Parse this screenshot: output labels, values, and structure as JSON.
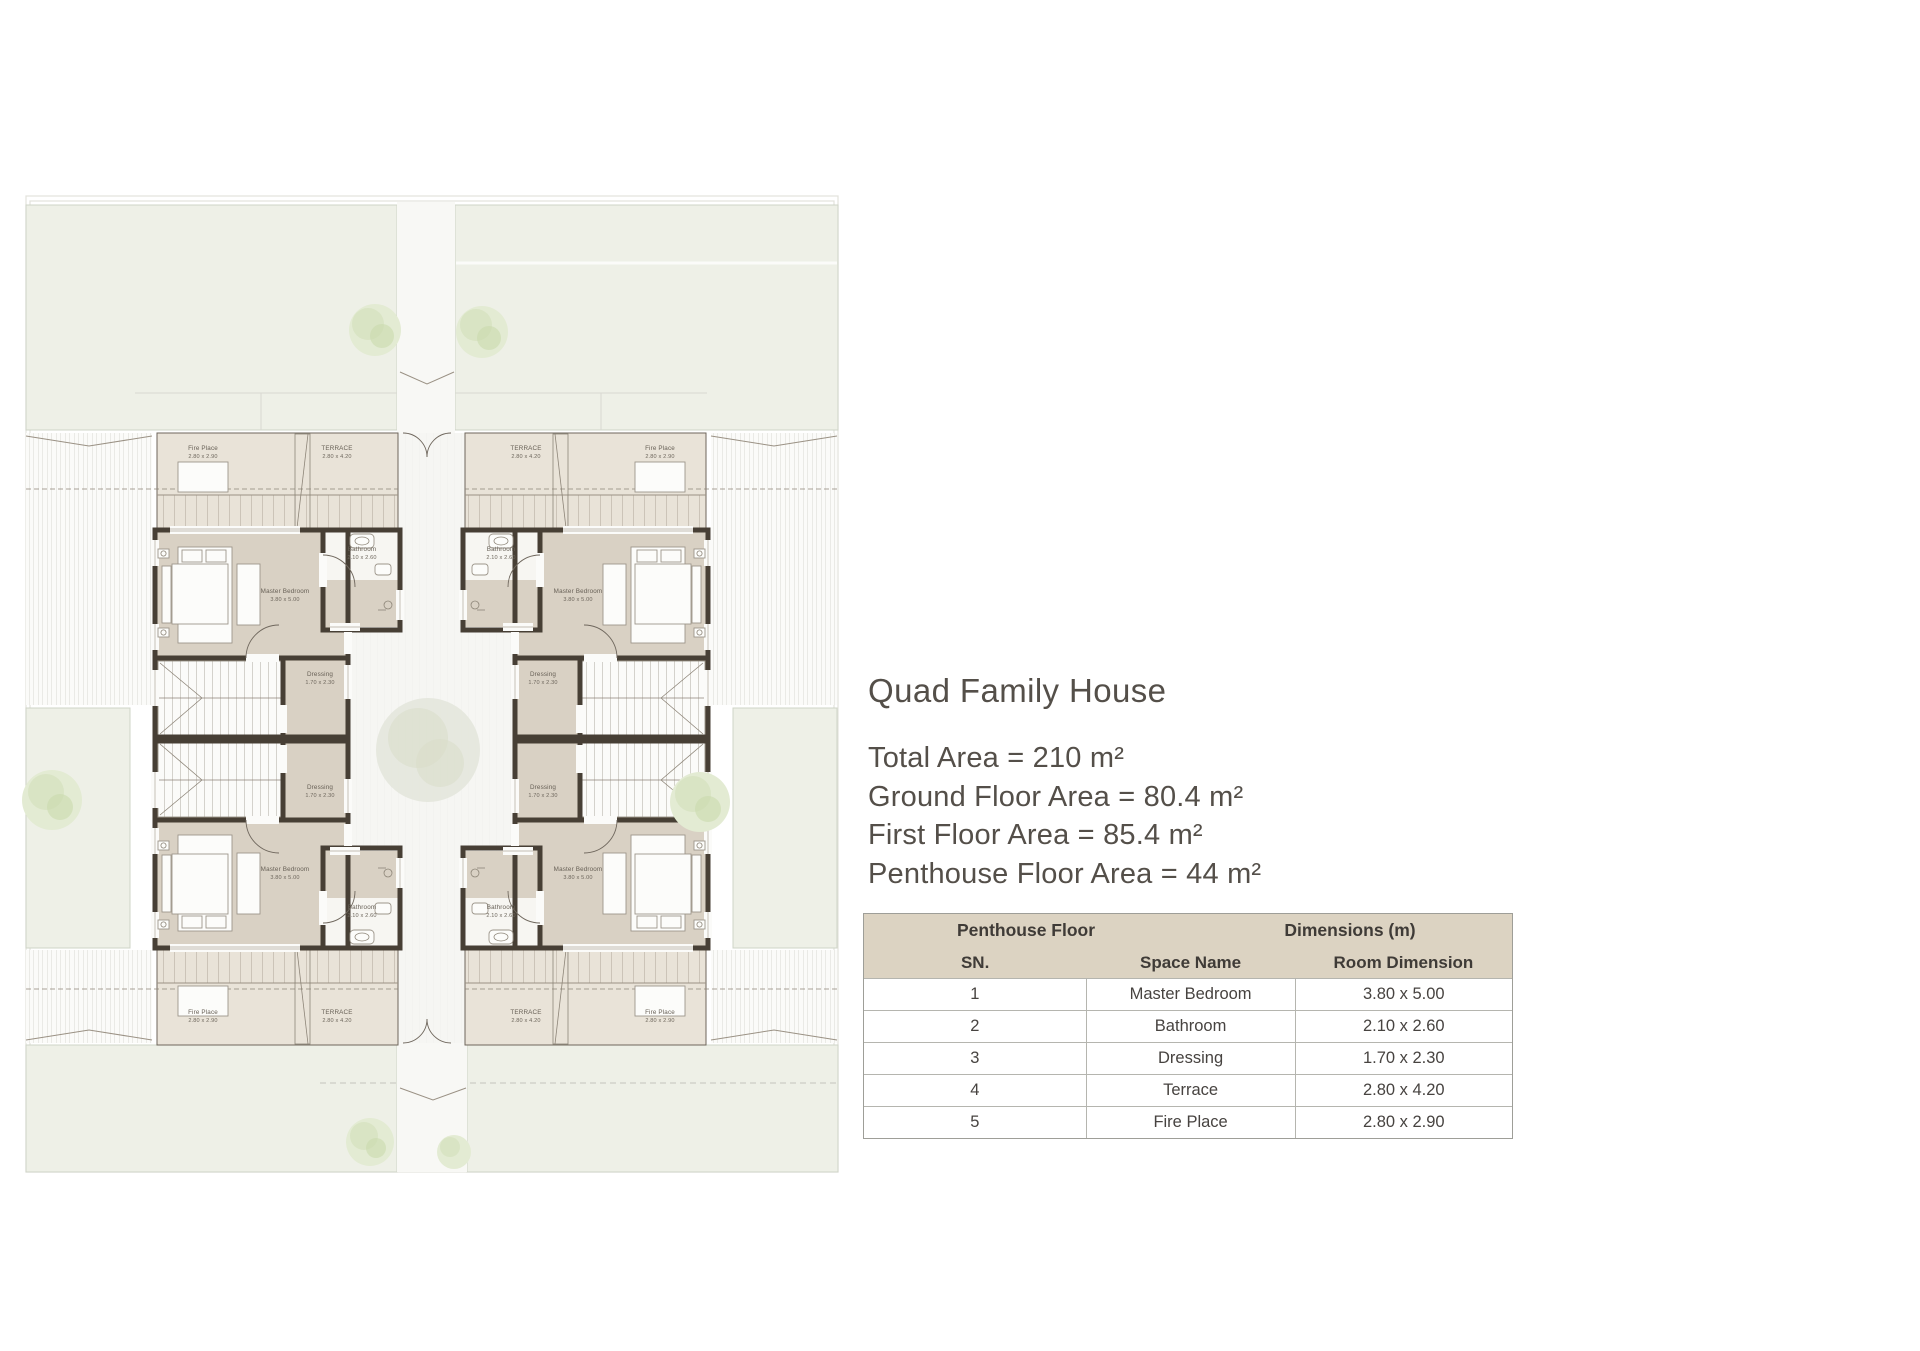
{
  "panel": {
    "title": "Quad Family House",
    "area_lines": [
      "Total Area = 210 m²",
      "Ground Floor Area = 80.4 m²",
      "First Floor Area = 85.4 m²",
      "Penthouse Floor Area = 44 m²"
    ]
  },
  "table": {
    "group_headers": [
      "Penthouse Floor",
      "Dimensions (m)"
    ],
    "columns": [
      "SN.",
      "Space Name",
      "Room Dimension"
    ],
    "rows": [
      {
        "sn": "1",
        "space": "Master Bedroom",
        "dim": "3.80 x 5.00"
      },
      {
        "sn": "2",
        "space": "Bathroom",
        "dim": "2.10 x 2.60"
      },
      {
        "sn": "3",
        "space": "Dressing",
        "dim": "1.70 x 2.30"
      },
      {
        "sn": "4",
        "space": "Terrace",
        "dim": "2.80 x 4.20"
      },
      {
        "sn": "5",
        "space": "Fire Place",
        "dim": "2.80 x 2.90"
      }
    ]
  },
  "plan": {
    "floor_name": "Penthouse Floor",
    "rooms": {
      "master_bedroom": {
        "name": "Master Bedroom",
        "dim": "3.80 x 5.00"
      },
      "bathroom": {
        "name": "Bathroom",
        "dim": "2.10 x 2.60"
      },
      "dressing": {
        "name": "Dressing",
        "dim": "1.70 x 2.30"
      },
      "terrace": {
        "name": "TERRACE",
        "dim": "2.80 x 4.20"
      },
      "fire_place": {
        "name": "Fire Place",
        "dim": "2.80 x 2.90"
      }
    },
    "colors": {
      "garden": "#eef0e7",
      "room_floor": "#d9d1c4",
      "terrace_floor": "#e9e3d8",
      "wall": "#473f35",
      "bathroom_floor": "#f7f6f2",
      "courtyard": "#f6f6f3",
      "text": "#544f49",
      "table_header": "#dcd3c2"
    }
  }
}
